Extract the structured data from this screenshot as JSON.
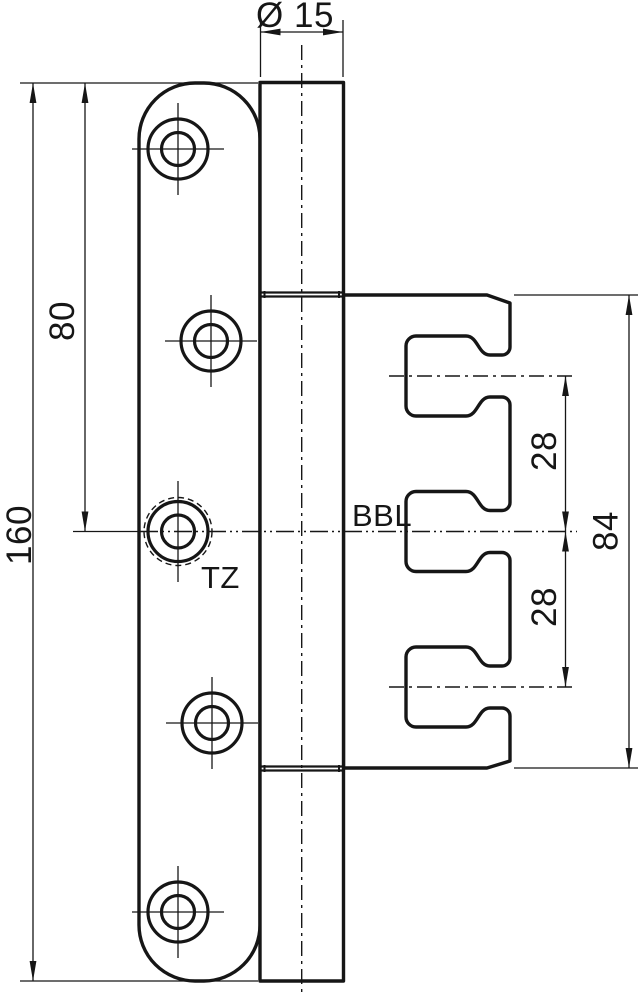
{
  "drawing_labels": {
    "bbl": "BBL",
    "tz": "TZ"
  },
  "dimensions": {
    "pin_diameter": "Ø 15",
    "leaf_length": "160",
    "top_to_center": "80",
    "slot_spacing_upper": "28",
    "slot_spacing_lower": "28",
    "frame_part_length": "84"
  },
  "colors": {
    "line_color": "#161616",
    "background": "#ffffff"
  }
}
